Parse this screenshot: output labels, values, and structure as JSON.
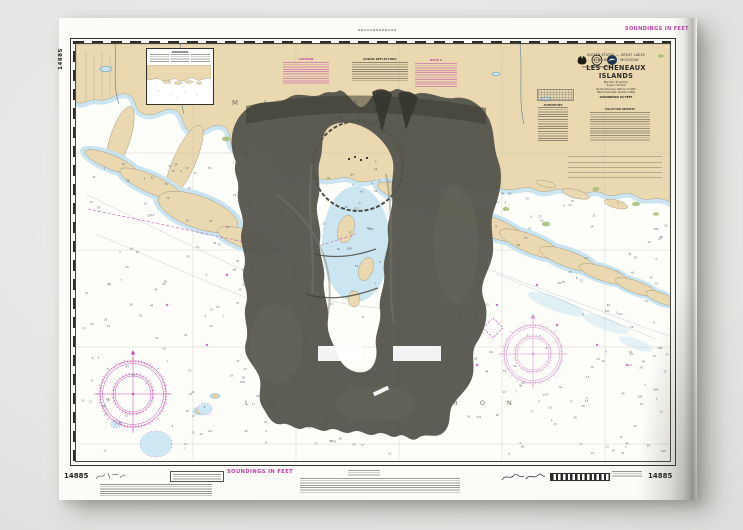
{
  "chart": {
    "number": "14885",
    "soundings_note": "SOUNDINGS IN FEET",
    "title_block": {
      "nation": "UNITED STATES — GREAT LAKES",
      "region": "LAKE HURON · MICHIGAN",
      "title": "LES CHENEAUX ISLANDS",
      "projection": "Mercator Projection",
      "scale": "Scale 1:30,000",
      "datum": "North American Datum of 1983",
      "datum_note": "(World Geodetic System 1984)",
      "soundings": "SOUNDINGS IN FEET"
    },
    "place_labels": {
      "michigan": "MICHIGAN",
      "lake_huron": "LAKE HURON",
      "marquette": "MARQUETTE"
    },
    "notes": {
      "caution": "CAUTION",
      "radar": "RADAR REFLECTORS",
      "note_a": "NOTE A",
      "authorities": "AUTHORITIES",
      "pollution": "POLLUTION REPORTS"
    },
    "soundings_sample": [
      3,
      4,
      5,
      6,
      7,
      8,
      9,
      11,
      12,
      13,
      15,
      16,
      17,
      19,
      21,
      23,
      24,
      26,
      29,
      31,
      34,
      37,
      42,
      46,
      52,
      58,
      65,
      72,
      84,
      97,
      108,
      121
    ],
    "colors": {
      "magenta": "#c23fa9",
      "land_tan": "#e9d8b0",
      "shallow_blue": "#c7e3f0",
      "marsh_green": "#a4bd72",
      "overlay_gray": "#53534a"
    }
  }
}
